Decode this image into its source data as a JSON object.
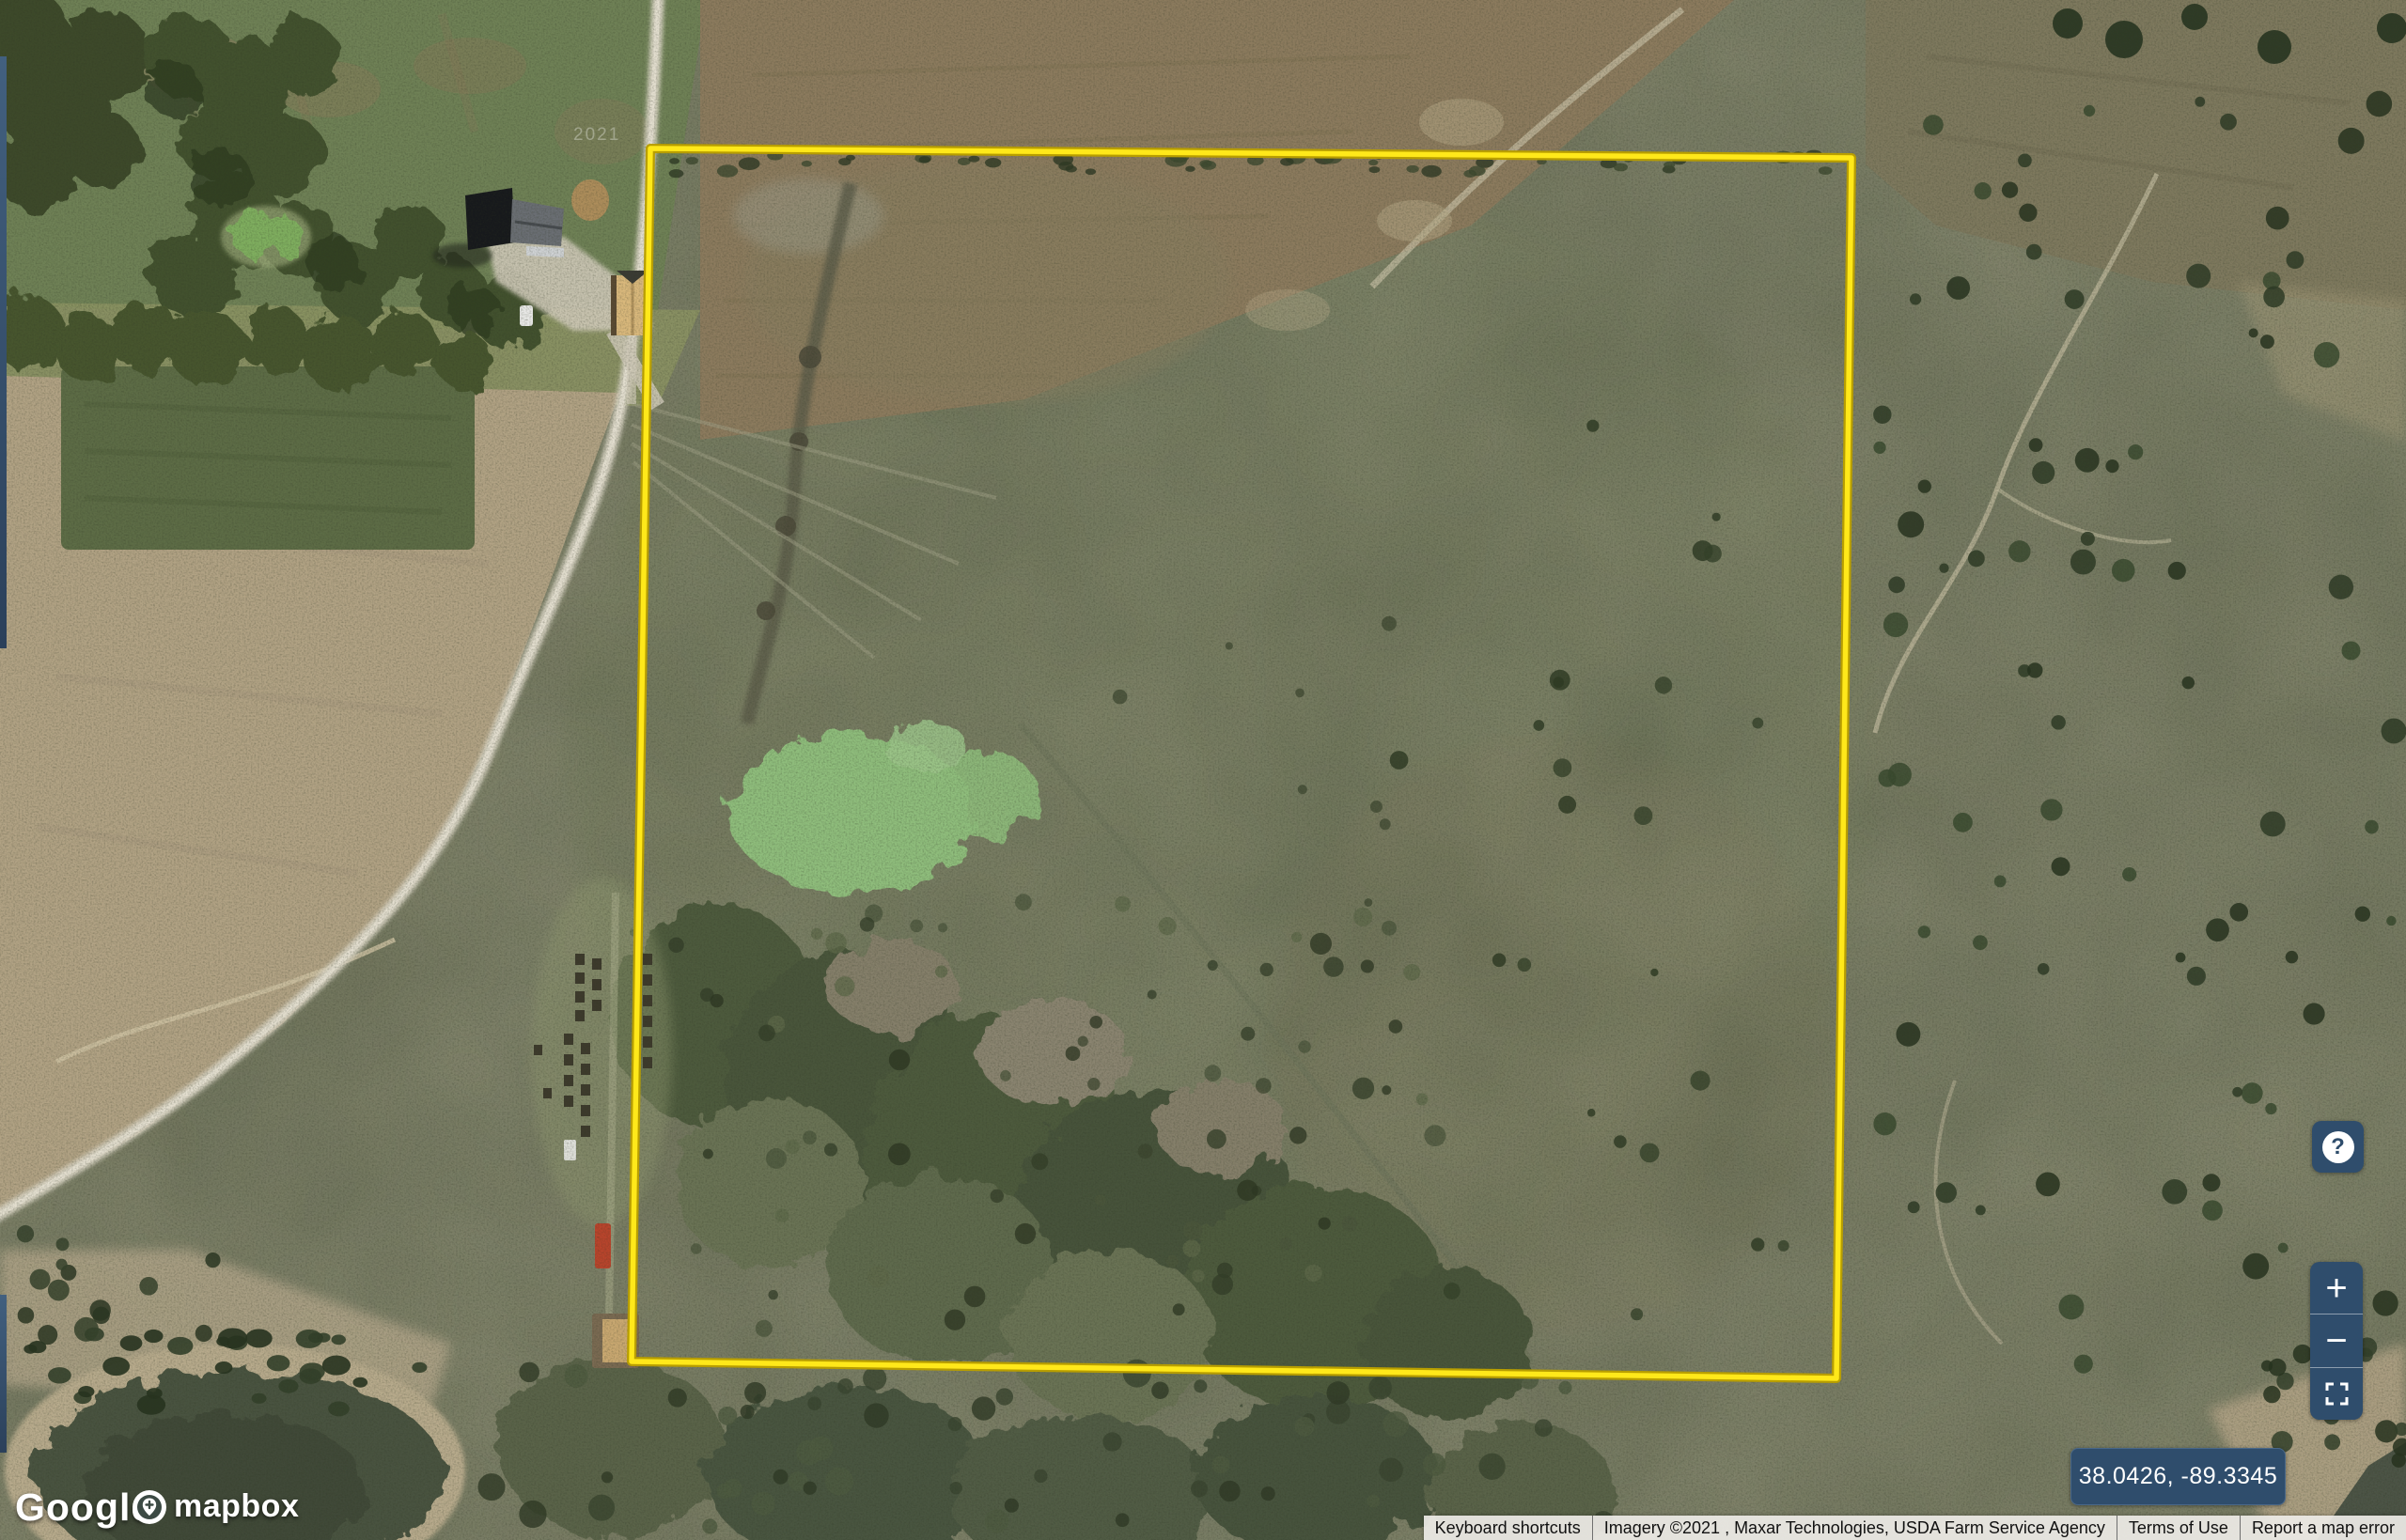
{
  "boundary": {
    "points_px": "692,158 1970,168 1954,1467 672,1449",
    "edge_color": "#b89e00",
    "stroke_color": "#ffe81a"
  },
  "logos": {
    "google": "Google",
    "mapbox": "mapbox"
  },
  "coordinates_badge": {
    "text": "38.0426, -89.3345",
    "bg": "#2f4d6c"
  },
  "attribution": {
    "keyboard_shortcuts": "Keyboard shortcuts",
    "imagery": "Imagery ©2021 , Maxar Technologies, USDA Farm Service Agency",
    "terms_of_use": "Terms of Use",
    "report_error": "Report a map error"
  },
  "controls": {
    "help_glyph": "?",
    "zoom_in_glyph": "+",
    "zoom_out_glyph": "−"
  },
  "watermark": {
    "year": "2021"
  },
  "colors": {
    "control_bg": "#2f4d6c",
    "control_fg": "#ffffff",
    "attribution_bg": "#eeece7",
    "attribution_fg": "#111111",
    "boundary_yellow": "#ffe81a"
  }
}
